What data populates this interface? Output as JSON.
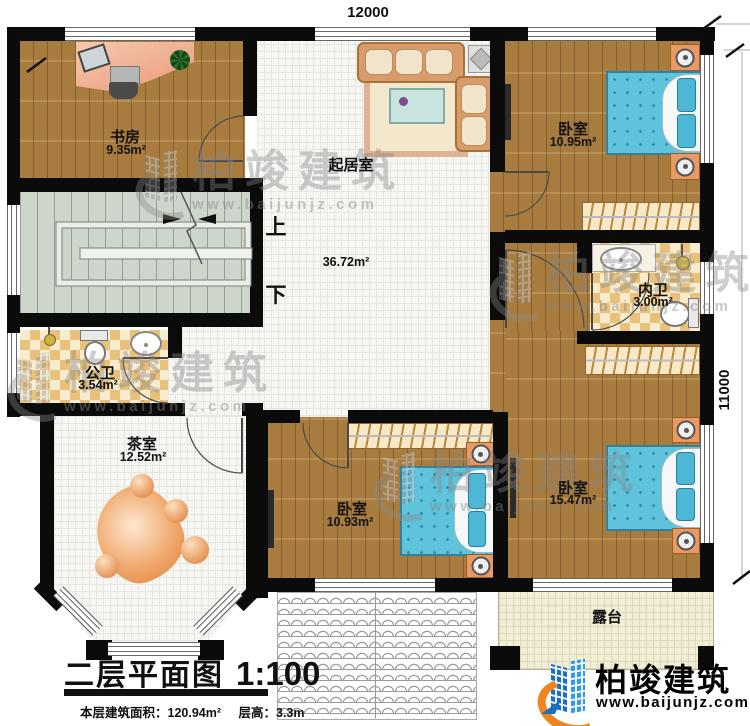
{
  "dimensions": {
    "top": "12000",
    "right": "11000"
  },
  "rooms": {
    "study": {
      "name": "书房",
      "area": "9.35m²"
    },
    "living": {
      "name": "起居室",
      "area": "36.72m²"
    },
    "bedroom1": {
      "name": "卧室",
      "area": "10.95m²"
    },
    "inner_bath": {
      "name": "内卫",
      "area": "3.00m²"
    },
    "public_bath": {
      "name": "公卫",
      "area": "3.54m²"
    },
    "tea": {
      "name": "茶室",
      "area": "12.52m²"
    },
    "bedroom2": {
      "name": "卧室",
      "area": "10.93m²"
    },
    "bedroom3": {
      "name": "卧室",
      "area": "15.47m²"
    },
    "terrace": {
      "name": "露台"
    }
  },
  "stairs": {
    "up": "上",
    "down": "下"
  },
  "title": {
    "text": "二层平面图",
    "scale": "1:100",
    "info_area": "本层建筑面积：120.94m²",
    "info_height": "层高：3.3m"
  },
  "brand": {
    "name": "柏竣建筑",
    "website": "www.baijunjz.com"
  },
  "watermark": {
    "name": "柏竣建筑",
    "website": "www.baijunjz.com"
  },
  "colors": {
    "wall": "#0b0b0b",
    "wood_floor": "#a87c3e",
    "tile_dark": "#eac17b",
    "tile_light": "#f8eccf",
    "stair_floor": "#ced5ca",
    "grid_floor": "#f6f6f3",
    "terrace_floor": "#f2edd5",
    "bed_blue": "#5fc3dc",
    "brand_blue": "#1a6fc0",
    "brand_orange": "#f08420",
    "watermark_gray": "#8a8a8a"
  }
}
